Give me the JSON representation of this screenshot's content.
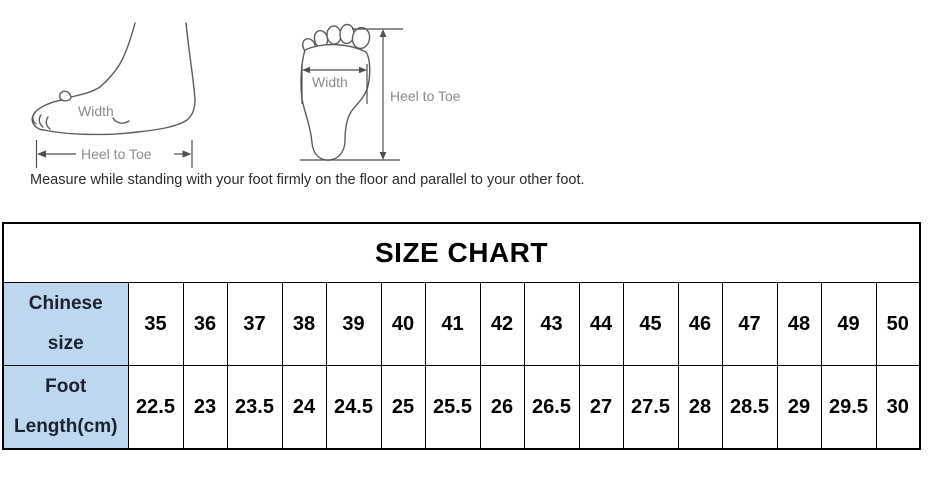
{
  "measurement_guide": {
    "side_view": {
      "width_label": "Width",
      "heel_to_toe_label": "Heel to Toe"
    },
    "bottom_view": {
      "width_label": "Width",
      "heel_to_toe_label": "Heel to Toe"
    },
    "note": "Measure while standing with your foot firmly on the floor and parallel to your other foot."
  },
  "size_chart": {
    "title": "SIZE CHART",
    "row1": {
      "header_line1": "Chinese",
      "header_line2": "size",
      "values": [
        "35",
        "36",
        "37",
        "38",
        "39",
        "40",
        "41",
        "42",
        "43",
        "44",
        "45",
        "46",
        "47",
        "48",
        "49",
        "50"
      ]
    },
    "row2": {
      "header_line1": "Foot",
      "header_line2": "Length(cm)",
      "values": [
        "22.5",
        "23",
        "23.5",
        "24",
        "24.5",
        "25",
        "25.5",
        "26",
        "26.5",
        "27",
        "27.5",
        "28",
        "28.5",
        "29",
        "29.5",
        "30"
      ]
    }
  },
  "colors": {
    "header_bg": "#BDD7EE",
    "header_text": "#1b2130",
    "table_border": "#000000",
    "diagram_stroke": "#5d5d5f",
    "label_gray": "#8c8c8c"
  }
}
